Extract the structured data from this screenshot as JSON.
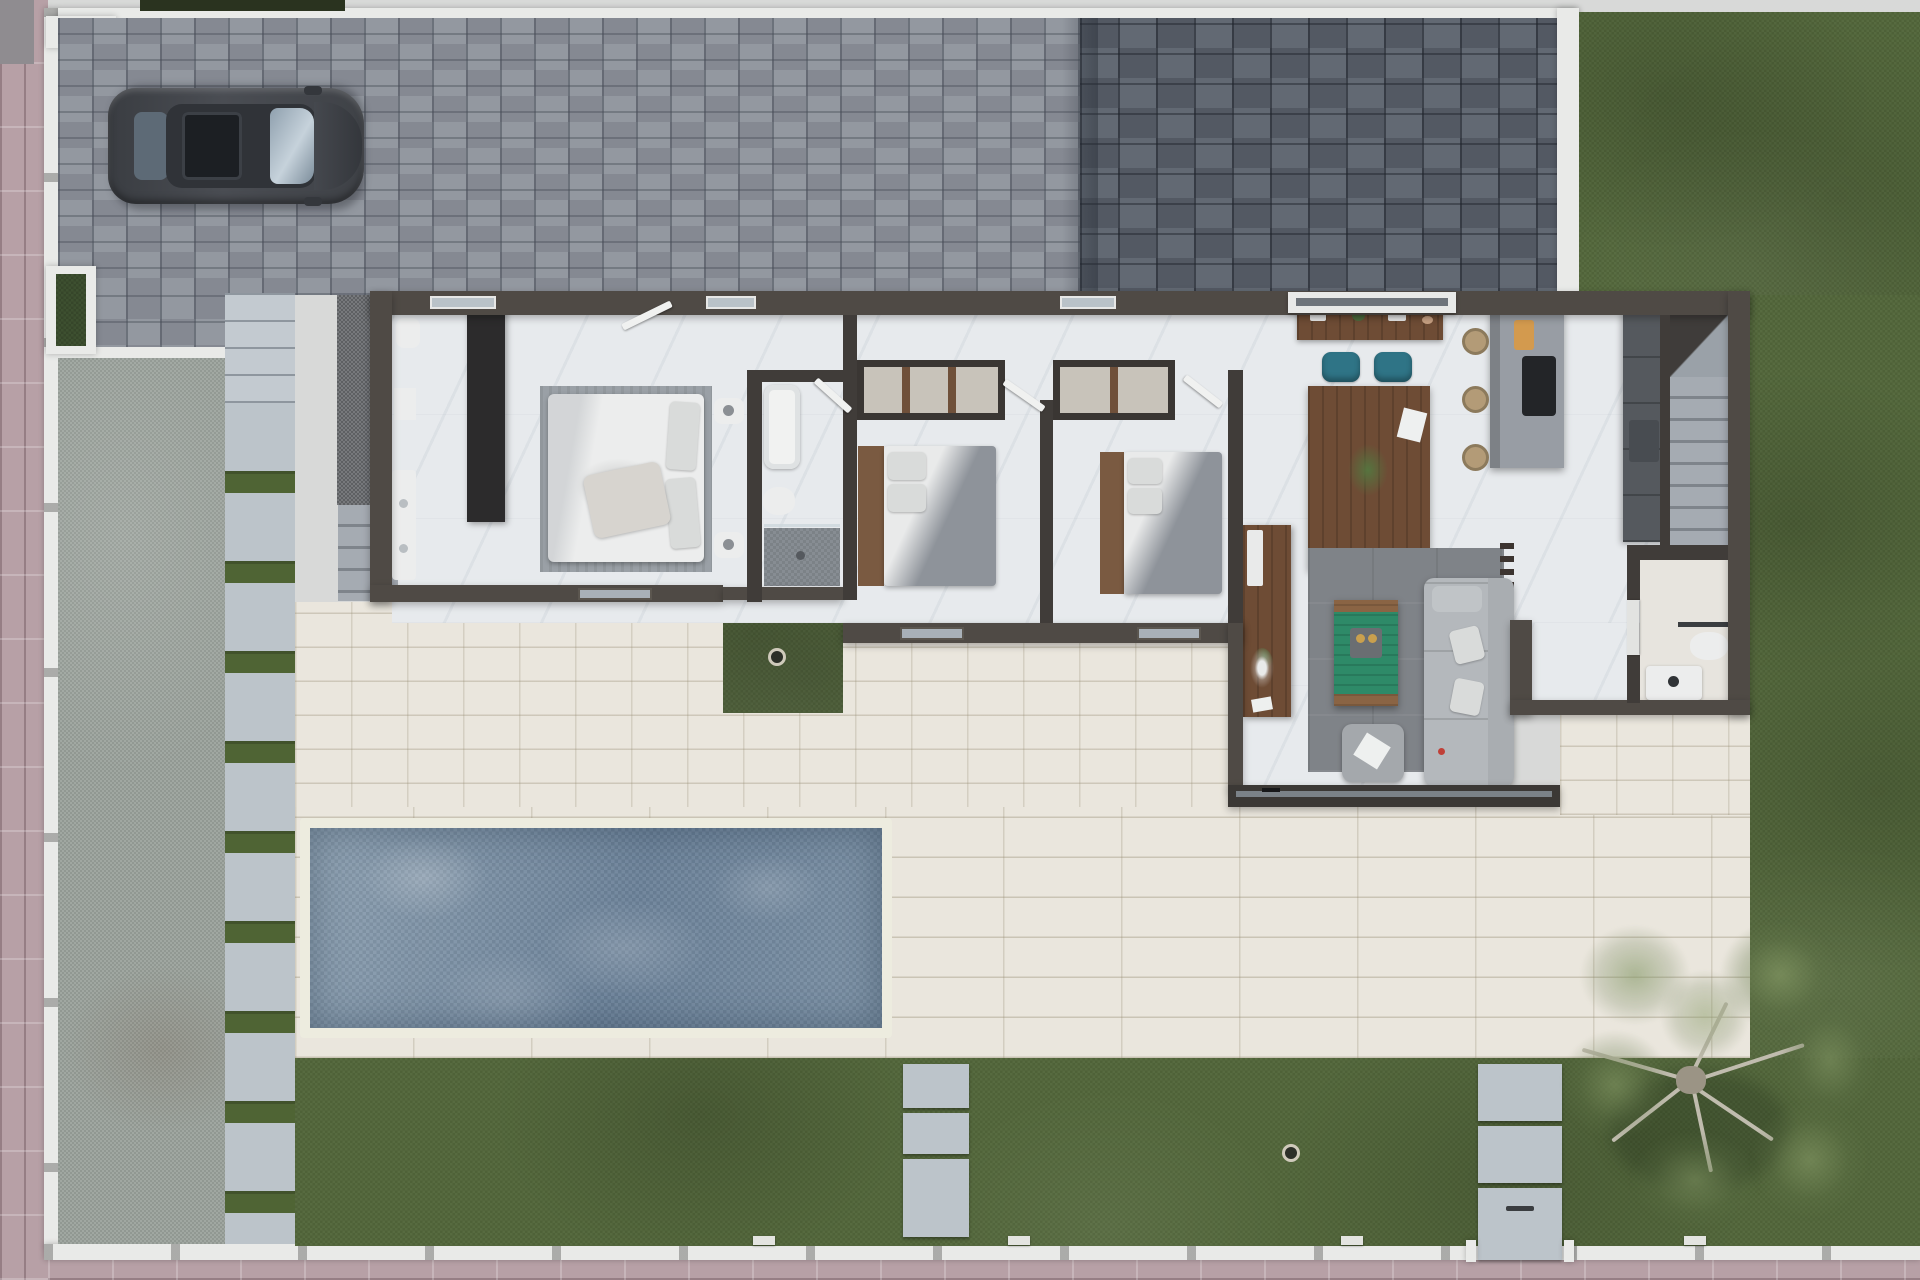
{
  "scene": {
    "title": "Top-down 3D render — single-storey villa floor plan with pool and garden",
    "width": 1920,
    "height": 1280,
    "visible_text": []
  },
  "palette": {
    "sidewalk": "#b7a0a6",
    "wallWhite": "#e9eae8",
    "hedge": "#2a331f",
    "paverLight": "#8d929b",
    "paverDark": "#5a616b",
    "lawn": "#52663a",
    "grassInset": "#4f6434",
    "gravel": "#9aa29b",
    "pad": "#bcc4ca",
    "terrace": "#eae6dd",
    "poolWater": "#7b90a4",
    "poolLight": "#8da0b1",
    "poolDeep": "#6c8299",
    "coping": "#edecdf",
    "wall": "#4f4a45",
    "partition": "#403c39",
    "glass": "#7b8288",
    "floor": "#e7eaed",
    "floorWarm": "#e7e4de",
    "wood": "#6e4c35",
    "woodLight": "#8a6444",
    "headboard": "#7a5a41",
    "wardrobe": "#2c2b2c",
    "white": "#eceded",
    "greyRug": "#9aa0a6",
    "darkRug": "#7f8388",
    "sofa": "#b4b8bc",
    "ottoman": "#a4a8ac",
    "teal": "#2f7486",
    "tableGreen": "#2e8a68",
    "island": "#989da4",
    "counter": "#55595e",
    "cooktop": "#232528",
    "board": "#d39a4e",
    "stool": "#b39b77",
    "tread": "#a5abb2",
    "treadDark": "#7e848b",
    "carBody": "#41444a",
    "carRoof": "#303338",
    "carGlassFront": "#8fa0ae",
    "carGlassRear": "#5d6a76",
    "sunroof": "#1c1f23",
    "treeBranch": "#c0bcae",
    "treeFoliage": "#6e8255",
    "accentRed": "#c04038"
  },
  "plan": {
    "exterior_areas": [
      {
        "name": "street-sidewalk",
        "surface": "pink concrete tiles",
        "sides": [
          "left",
          "bottom"
        ]
      },
      {
        "name": "boundary-wall",
        "surface": "white masonry with posts"
      },
      {
        "name": "driveway",
        "surface": "light grey block pavers",
        "contains": [
          "parked-car"
        ]
      },
      {
        "name": "entry-court",
        "surface": "dark grey block pavers"
      },
      {
        "name": "front-lawn",
        "surface": "artificial grass"
      },
      {
        "name": "side-lawn-right",
        "surface": "artificial grass"
      },
      {
        "name": "back-lawn",
        "surface": "artificial grass",
        "contains": [
          "garden-tree",
          "stepping-stones",
          "pedestrian-gate",
          "lawn-drain"
        ]
      },
      {
        "name": "side-gravel-yard",
        "surface": "grey gravel"
      },
      {
        "name": "stepping-stone-path",
        "surface": "pale pads with grass joints"
      },
      {
        "name": "terrace",
        "surface": "cream stone tiles"
      },
      {
        "name": "swimming-pool",
        "surface": "water with white coping"
      },
      {
        "name": "grass-inset-patio",
        "surface": "artificial grass with drain"
      }
    ],
    "rooms": [
      {
        "name": "master-suite",
        "furniture": [
          "wall-hung-toilet",
          "vanity-double-sink",
          "black-wardrobe",
          "double-bed",
          "nightstand-x2",
          "rug"
        ]
      },
      {
        "name": "shared-bathroom",
        "furniture": [
          "bathtub",
          "toilet",
          "walk-in-shower"
        ]
      },
      {
        "name": "bedroom-2",
        "furniture": [
          "open-wardrobe-niche",
          "double-bed-grey"
        ]
      },
      {
        "name": "bedroom-3",
        "furniture": [
          "open-wardrobe-niche",
          "double-bed-grey"
        ]
      },
      {
        "name": "hallway",
        "furniture": [
          "open-door-leaves"
        ]
      },
      {
        "name": "dining-area",
        "furniture": [
          "sideboard",
          "dining-table",
          "teal-chair-x4",
          "plant-centerpiece"
        ]
      },
      {
        "name": "kitchen",
        "furniture": [
          "island-with-cooktop",
          "cutting-board",
          "wicker-stool-x3",
          "tall-counter-run"
        ]
      },
      {
        "name": "staircase",
        "furniture": [
          "landing",
          "treads"
        ]
      },
      {
        "name": "living-room",
        "furniture": [
          "tv-console",
          "blanket-ladder",
          "dark-rug",
          "green-coffee-table",
          "ottoman",
          "sofa"
        ]
      },
      {
        "name": "guest-toilet",
        "furniture": [
          "towel-bar",
          "toilet",
          "washbasin"
        ]
      }
    ],
    "openings": [
      {
        "name": "entry-sliding-door",
        "wall": "north"
      },
      {
        "name": "window-master-north",
        "wall": "north"
      },
      {
        "name": "window-hall-north",
        "wall": "north"
      },
      {
        "name": "window-bedroom3-north",
        "wall": "north"
      },
      {
        "name": "window-master-south",
        "wall": "south"
      },
      {
        "name": "window-bedroom2-south",
        "wall": "south"
      },
      {
        "name": "window-bedroom3-south",
        "wall": "south"
      },
      {
        "name": "living-glass-slider",
        "wall": "south"
      }
    ],
    "vehicle": {
      "name": "parked-car",
      "type": "dark grey SUV seen from above",
      "facing": "east"
    }
  }
}
